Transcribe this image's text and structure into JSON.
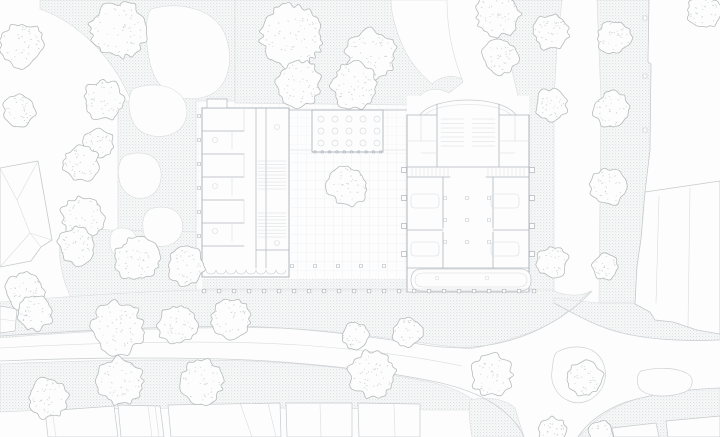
{
  "meta": {
    "width": 720,
    "height": 437,
    "kind": "architectural-site-plan"
  },
  "colors": {
    "bg": "#fdfdfd",
    "line": "#c6cacd",
    "wall": "#b0b7bd",
    "faint": "#d9dcde",
    "curb": "#cdd1d4",
    "paving_bg": "#f6f7f7",
    "paving_dot": "#d9dcde",
    "grid_line": "#eceef0",
    "tree_line": "#b6bbbb",
    "speckle": "#c8cccc"
  },
  "trees": [
    [
      22,
      45,
      24
    ],
    [
      118,
      30,
      30
    ],
    [
      20,
      110,
      17
    ],
    [
      104,
      100,
      21
    ],
    [
      99,
      143,
      16
    ],
    [
      292,
      36,
      33
    ],
    [
      371,
      55,
      27
    ],
    [
      299,
      83,
      24
    ],
    [
      355,
      86,
      25
    ],
    [
      498,
      14,
      24
    ],
    [
      551,
      32,
      19
    ],
    [
      614,
      37,
      18
    ],
    [
      500,
      57,
      19
    ],
    [
      551,
      105,
      17
    ],
    [
      612,
      110,
      19
    ],
    [
      608,
      187,
      19
    ],
    [
      552,
      262,
      17
    ],
    [
      605,
      267,
      14
    ],
    [
      348,
      186,
      21
    ],
    [
      81,
      163,
      19
    ],
    [
      83,
      217,
      23
    ],
    [
      77,
      246,
      20
    ],
    [
      137,
      259,
      23
    ],
    [
      186,
      266,
      20
    ],
    [
      25,
      291,
      20
    ],
    [
      35,
      312,
      19
    ],
    [
      118,
      328,
      28
    ],
    [
      177,
      325,
      21
    ],
    [
      231,
      319,
      21
    ],
    [
      120,
      381,
      25
    ],
    [
      48,
      398,
      21
    ],
    [
      202,
      382,
      23
    ],
    [
      372,
      374,
      25
    ],
    [
      355,
      336,
      14
    ],
    [
      408,
      332,
      16
    ],
    [
      492,
      375,
      22
    ],
    [
      585,
      378,
      19
    ],
    [
      553,
      431,
      15
    ],
    [
      601,
      433,
      13
    ],
    [
      704,
      12,
      18
    ]
  ],
  "layers": [
    {
      "name": "paving",
      "shapes": [
        {
          "d": "M40,0 L235,0 L235,101 L196,101 L196,268 L118,268 L118,101 L131,101 C113,57 79,23 40,9 Z",
          "f": "pav",
          "s": "faint",
          "w": 0.6
        },
        {
          "d": "M60,240 C70,232 90,228 110,230 L196,232 L196,292 L72,300 C62,280 58,258 60,240 Z",
          "f": "pav",
          "s": "faint",
          "w": 0.6
        },
        {
          "d": "M235,0 L446,0 C446,28 452,57 463,82 L449,93 C437,86 425,89 417,99 L413,105 L235,103 Z",
          "f": "pav",
          "s": "faint",
          "w": 0.6
        },
        {
          "d": "M479,0 L562,0 L557,46 L554,100 L554,298 L521,298 L519,100 L507,49 L485,15 Z",
          "f": "pav",
          "s": "faint",
          "w": 0.6
        },
        {
          "d": "M597,0 L649,0 L648,62 L651,64 L650,150 L645,192 L641,239 L637,266 L635,303 L599,303 L601,100 Z",
          "f": "pav",
          "s": "faint",
          "w": 0.6
        },
        {
          "d": "M0,302 C70,296 150,291 200,290 L552,290 C562,295 578,298 591,291 L561,317 C540,331 510,341 470,349 C430,345 370,334 300,329 C220,325 80,331 0,338 Z",
          "f": "pav",
          "s": "faint",
          "w": 0.6
        },
        {
          "d": "M0,364 C90,360 180,359 250,361 C320,364 380,372 430,382 C448,386 462,392 472,399 L478,410 L430,410 C300,407 100,407 0,412 Z",
          "f": "pav",
          "s": "faint",
          "w": 0.6
        },
        {
          "d": "M554,298 L598,303 L635,303 L650,312 L655,320 L673,322 L697,330 L720,334 L720,340 C670,342 630,338 600,326 C580,318 564,308 554,303 Z",
          "f": "pav",
          "s": "faint",
          "w": 0.6
        },
        {
          "d": "M578,437 L720,437 L720,388 C692,389 660,393 641,398 C616,404 597,417 587,429 Z",
          "f": "pav",
          "s": "faint",
          "w": 0.6
        },
        {
          "d": "M470,400 C488,396 505,399 515,408 L524,437 L472,437 C470,424 468,410 470,400 Z",
          "f": "pav",
          "s": "faint",
          "w": 0.6
        },
        {
          "d": "M202,279 L538,279 L538,289 L202,289 Z",
          "f": "pav",
          "s": "none"
        }
      ]
    },
    {
      "name": "plaza-grid",
      "shapes": [
        {
          "d": "M196,96 L540,96 L540,296 L196,296 Z",
          "f": "grid",
          "s": "none"
        }
      ]
    },
    {
      "name": "garden-paths",
      "shapes": [
        {
          "d": "M151,9 C178,1 212,8 224,32 C234,55 231,82 212,94 C189,105 163,97 153,73 C146,53 143,21 151,9 Z",
          "f": "bg",
          "s": "faint",
          "w": 0.6
        },
        {
          "d": "M391,0 L447,0 C447,26 452,54 462,79 C452,74 441,76 432,84 C420,74 408,60 401,42 C395,28 391,12 391,0 Z",
          "f": "bg",
          "s": "faint",
          "w": 0.6
        },
        {
          "d": "M133,89 C150,82 172,84 182,97 C190,108 188,124 176,132 C162,140 142,137 134,124 C128,113 127,97 133,89 Z",
          "f": "bg",
          "s": "faint",
          "w": 0.6
        },
        {
          "d": "M124,156 C138,150 154,153 159,165 C164,177 160,192 148,197 C136,201 124,195 120,183 C117,173 118,162 124,156 Z",
          "f": "bg",
          "s": "faint",
          "w": 0.6
        },
        {
          "d": "M150,209 C165,204 179,209 182,221 C185,233 178,244 165,246 C153,248 144,241 143,229 C142,220 144,213 150,209 Z",
          "f": "bg",
          "s": "faint",
          "w": 0.6
        },
        {
          "d": "M116,229 C126,226 135,230 137,239 C139,248 133,256 124,257 C116,258 110,252 110,243 C110,236 111,231 116,229 Z",
          "f": "bg",
          "s": "faint",
          "w": 0.6
        }
      ]
    },
    {
      "name": "roads",
      "shapes": [
        {
          "d": "M0,336 C100,329 200,325 262,327 C330,330 392,340 432,346 C470,351 502,345 531,333 C556,322 577,307 592,291",
          "s": "curb",
          "w": 0.8
        },
        {
          "d": "M0,361 C100,357 198,357 268,361 C340,366 400,374 441,383 C462,388 480,395 494,404 C509,414 519,425 524,437",
          "s": "curb",
          "w": 0.8
        },
        {
          "d": "M554,303 C564,308 580,318 600,326 C630,338 670,342 720,340",
          "s": "curb",
          "w": 0.7
        },
        {
          "d": "M578,437 C590,419 612,404 641,398 C661,393 692,389 720,388",
          "s": "curb",
          "w": 0.8
        },
        {
          "d": "M0,348 C110,342 220,340 300,345 C370,350 424,358 462,366",
          "s": "faint",
          "w": 0.6
        },
        {
          "d": "M557,352 C570,345 586,345 596,353 C606,362 608,376 602,388 C595,400 581,406 569,401 C557,396 550,384 552,371 C553,363 553,356 557,352 Z",
          "f": "bg",
          "s": "curb",
          "w": 0.7
        },
        {
          "d": "M641,371 C658,367 677,367 688,374 C694,378 694,388 685,392 C669,398 651,397 642,391 C636,387 636,375 641,371 Z",
          "f": "bg",
          "s": "curb",
          "w": 0.7
        }
      ]
    },
    {
      "name": "left-neighbor-building",
      "shapes": [
        {
          "d": "M0,168 L38,161 L52,240 L41,247 L31,261 L0,267 Z",
          "f": "bg",
          "s": "line",
          "w": 0.8
        },
        {
          "d": "M0,168 L17,200 M38,161 L17,200 M17,200 L30,233 M52,240 L30,233 M41,247 L30,233 M0,267 L30,233",
          "s": "faint",
          "w": 0.6
        },
        {
          "d": "M0,306 L17,309 L15,331 L0,333 Z",
          "f": "bg",
          "s": "line",
          "w": 0.7
        },
        {
          "d": "M0,319 L15,321",
          "s": "faint",
          "w": 0.6
        }
      ]
    },
    {
      "name": "right-neighbor-building",
      "shapes": [
        {
          "d": "M645,192 L720,181 L720,334 L697,330 L673,322 L655,320 L650,312 L635,304 L637,266 L641,239 Z",
          "f": "bg",
          "s": "line",
          "w": 0.8
        },
        {
          "d": "M659,196 L656,303 M690,188 L688,326",
          "s": "faint",
          "w": 0.6
        },
        {
          "d": "M649,0 L648,62 L651,64 L650,150 L645,192",
          "s": "line",
          "w": 0.7
        },
        {
          "t": "sq_set",
          "xs": [
            645
          ],
          "ys": [
            18,
            76,
            130
          ],
          "sz": 4,
          "s": "line",
          "f": "bg",
          "w": 0.6
        }
      ]
    },
    {
      "name": "bottom-buildings",
      "shapes": [
        {
          "d": "M45,411 L114,406 L118,437 L48,437 Z",
          "f": "bg",
          "s": "line",
          "w": 0.7
        },
        {
          "d": "M118,405 L160,406 L164,437 L121,437 Z",
          "f": "bg",
          "s": "line",
          "w": 0.7
        },
        {
          "d": "M168,405 L280,403 L281,437 L171,437 Z",
          "f": "bg",
          "s": "line",
          "w": 0.7
        },
        {
          "d": "M286,403 L352,403 L352,437 L287,437 Z",
          "f": "bg",
          "s": "line",
          "w": 0.7
        },
        {
          "d": "M358,403 L420,404 L420,437 L359,437 Z",
          "f": "bg",
          "s": "line",
          "w": 0.7
        },
        {
          "d": "M612,428 L656,423 L659,437 L614,437 Z",
          "f": "bg",
          "s": "line",
          "w": 0.7
        },
        {
          "d": "M666,421 L720,416 L720,437 L668,437 Z",
          "f": "bg",
          "s": "line",
          "w": 0.7
        },
        {
          "d": "M52,410 L56,437 M148,406 L152,437 M155,406 L159,437 M240,403 L252,437 M268,403 L276,437 M320,403 L321,437 M394,404 L395,437",
          "s": "faint",
          "w": 0.6
        }
      ]
    },
    {
      "name": "main-building-left-wing",
      "shapes": [
        {
          "d": "M202,108 L289,108 L289,277 L202,277 Z",
          "f": "bg",
          "s": "wall",
          "w": 1
        },
        {
          "d": "M207,99 L227,99 L227,108 L207,108 Z",
          "f": "bg",
          "s": "wall",
          "w": 0.7
        },
        {
          "d": "M256,108 L256,268 M266,108 L266,268",
          "s": "wall",
          "w": 0.7
        },
        {
          "d": "M202,131 L244,131 M202,154 L244,154 M202,177 L244,177 M202,200 L244,200 M202,223 L244,223 M202,246 L244,246 M256,250 L289,250",
          "s": "wall",
          "w": 0.7
        },
        {
          "d": "M232,131 L232,149 M232,177 L232,195 M232,223 L232,241 M244,108 L244,131 M244,154 L244,177 M244,200 L244,223",
          "s": "faint",
          "w": 0.6
        },
        {
          "t": "hlines",
          "x0": 258,
          "x1": 286,
          "y0": 161,
          "y1": 189,
          "n": 9,
          "s": "faint",
          "w": 0.5
        },
        {
          "t": "hlines",
          "x0": 258,
          "x1": 286,
          "y0": 213,
          "y1": 237,
          "n": 8,
          "s": "faint",
          "w": 0.5
        },
        {
          "t": "arc_row",
          "x0": 206,
          "x1": 286,
          "n": 8,
          "y": 270,
          "r": 4,
          "s": "line",
          "w": 0.6
        },
        {
          "t": "sq_col",
          "x": 199,
          "y0": 116,
          "y1": 260,
          "step": 24,
          "sz": 3,
          "s": "wall",
          "f": "bg",
          "w": 0.6
        },
        {
          "t": "circ_set",
          "pts": [
            [
              215,
              140
            ],
            [
              215,
              186
            ],
            [
              215,
              231
            ],
            [
              277,
              127
            ],
            [
              277,
              243
            ]
          ],
          "r": 2.5,
          "s": "faint",
          "w": 0.6
        }
      ]
    },
    {
      "name": "main-building-loggia",
      "shapes": [
        {
          "d": "M312,110 L383,110 L383,152 L312,152 Z",
          "f": "bg",
          "s": "wall",
          "w": 0.9
        },
        {
          "d": "M289,110 L312,110 M383,110 L407,110",
          "s": "wall",
          "w": 0.8
        },
        {
          "d": "M289,150 L312,150 M383,150 L407,150",
          "s": "faint",
          "w": 0.6
        },
        {
          "t": "circ_grid",
          "xs": [
            321,
            335,
            349,
            363,
            377
          ],
          "ys": [
            119,
            131,
            143
          ],
          "r": 3,
          "s": "faint",
          "w": 0.7
        },
        {
          "t": "circ_row",
          "x0": 315,
          "x1": 381,
          "step": 7.3,
          "y": 152,
          "r": 1.3,
          "s": "wall",
          "w": 0.6
        }
      ]
    },
    {
      "name": "main-building-courtyard",
      "shapes": [
        {
          "d": "M289,152 L407,152 L407,268 L289,268 Z",
          "f": "grid",
          "s": "none"
        },
        {
          "t": "sq_row",
          "y": 266,
          "x0": 292,
          "x1": 404,
          "step": 23,
          "sz": 3,
          "s": "wall",
          "f": "bg",
          "w": 0.6
        }
      ]
    },
    {
      "name": "main-building-right-wing",
      "shapes": [
        {
          "d": "M407,96 L529,96 L529,292 L407,292 Z",
          "f": "bg",
          "s": "none"
        },
        {
          "d": "M420,115 C434,95 502,95 516,115",
          "s": "line",
          "w": 0.8
        },
        {
          "d": "M425,115 C437,101 499,101 511,115",
          "s": "faint",
          "w": 0.6
        },
        {
          "d": "M407,115 L407,292 M529,115 L529,292",
          "s": "wall",
          "w": 1
        },
        {
          "d": "M407,115 L437,115 M499,115 L529,115 M437,104 L437,167 M499,104 L499,167 M407,167 L529,167 M407,177 L450,177 M486,177 L529,177 M443,177 L443,228 M493,177 L493,228 M407,230 L443,230 M493,230 L529,230 M443,232 L443,268 M493,232 L493,268 M407,268 L529,268 M407,292 L529,292",
          "s": "wall",
          "w": 0.8
        },
        {
          "d": "M407,141 L437,141 M499,141 L529,141 M421,115 L421,141 M515,115 L515,141 M421,153 L437,153 M499,153 L515,153",
          "s": "faint",
          "w": 0.6
        },
        {
          "t": "hlines",
          "x0": 441,
          "x1": 464,
          "y0": 119,
          "y1": 146,
          "n": 7,
          "s": "faint",
          "w": 0.5
        },
        {
          "t": "hlines",
          "x0": 472,
          "x1": 495,
          "y0": 119,
          "y1": 146,
          "n": 7,
          "s": "faint",
          "w": 0.5
        },
        {
          "t": "vlines",
          "x0": 412,
          "x1": 448,
          "y0": 168,
          "y1": 176,
          "n": 10,
          "s": "faint",
          "w": 0.5
        },
        {
          "t": "vlines",
          "x0": 488,
          "x1": 524,
          "y0": 168,
          "y1": 176,
          "n": 10,
          "s": "faint",
          "w": 0.5
        },
        {
          "d": "M415,194 L435,194 Q439,194 439,198 L439,204 Q439,208 435,208 L415,208 Q411,208 411,204 L411,198 Q411,194 415,194 Z M495,194 L515,194 Q519,194 519,198 L519,204 Q519,208 515,208 L495,208 Q491,208 491,204 L491,198 Q491,194 495,194 Z M415,242 L435,242 Q439,242 439,246 L439,252 Q439,256 435,256 L415,256 Q411,256 411,252 L411,246 Q411,242 415,242 Z M495,242 L515,242 Q519,242 519,246 L519,252 Q519,256 515,256 L495,256 Q491,256 491,252 L491,246 Q491,242 495,242 Z",
          "s": "faint",
          "w": 0.6
        },
        {
          "t": "sq_set",
          "xs": [
            445,
            467,
            489
          ],
          "ys": [
            198,
            220,
            242
          ],
          "sz": 3,
          "s": "line",
          "f": "bg",
          "w": 0.6
        },
        {
          "d": "M422,269 L520,269 Q531,269 531,280 Q531,291 520,291 L422,291 Q411,291 411,280 Q411,269 422,269 Z",
          "f": "bg",
          "s": "line",
          "w": 0.8
        },
        {
          "d": "M424,273 L518,273 Q527,273 527,280 Q527,287 518,287 L424,287 Q415,287 415,280 Q415,273 424,273 Z",
          "s": "faint",
          "w": 0.6
        },
        {
          "t": "sq_set",
          "xs": [
            437,
            487
          ],
          "ys": [
            278
          ],
          "sz": 3,
          "s": "faint",
          "f": "none",
          "w": 0.6
        },
        {
          "t": "sq_set",
          "xs": [
            532
          ],
          "ys": [
            170,
            198,
            226,
            254
          ],
          "sz": 5,
          "s": "wall",
          "f": "bg",
          "w": 0.7
        },
        {
          "t": "sq_set",
          "xs": [
            404
          ],
          "ys": [
            170,
            198,
            226,
            254
          ],
          "sz": 5,
          "s": "wall",
          "f": "bg",
          "w": 0.7
        }
      ]
    },
    {
      "name": "south-colonnade",
      "shapes": [
        {
          "d": "M203,289 L536,289",
          "s": "faint",
          "w": 0.5
        },
        {
          "t": "sq_row",
          "y": 291,
          "x0": 204,
          "x1": 534,
          "step": 15,
          "sz": 3.5,
          "s": "wall",
          "f": "bg",
          "w": 0.7
        }
      ]
    }
  ]
}
